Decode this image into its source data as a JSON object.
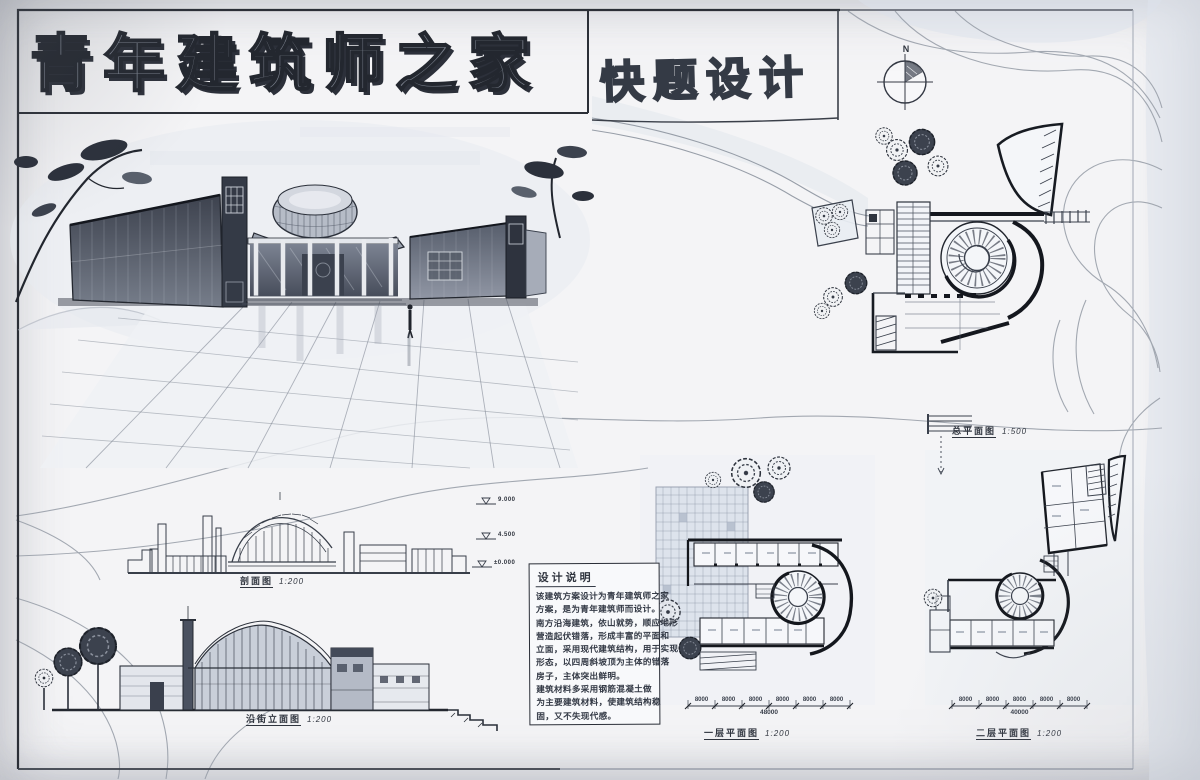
{
  "board": {
    "title_main": "青年建筑师之家",
    "title_sub": "快题设计",
    "north_label": "N"
  },
  "labels": {
    "site_plan": {
      "name": "总平面图",
      "scale": "1:500"
    },
    "section": {
      "name": "剖面图",
      "scale": "1:200"
    },
    "street_elevation": {
      "name": "沿街立面图",
      "scale": "1:200"
    },
    "floor_plan_1": {
      "name": "一层平面图",
      "scale": "1:200"
    },
    "floor_plan_2": {
      "name": "二层平面图",
      "scale": "1:200"
    }
  },
  "levels": [
    "9.000",
    "4.500",
    "±0.000"
  ],
  "notes": {
    "title": "设计说明",
    "lines": [
      "该建筑方案设计为青年建筑师之家",
      "方案，是为青年建筑师而设计。",
      "南方沿海建筑，依山就势，顺应地形",
      "营造起伏错落，形成丰富的平面和",
      "立面，采用现代建筑结构，用于实现",
      "形态，以四周斜坡顶为主体的错落",
      "房子，主体突出鲜明。",
      "建筑材料多采用钢筋混凝土做",
      "为主要建筑材料，使建筑结构稳",
      "固，又不失现代感。"
    ]
  },
  "dimensions": {
    "plan1": {
      "segments": [
        "8000",
        "8000",
        "8000",
        "8000",
        "8000",
        "8000"
      ],
      "total": "48000"
    },
    "plan2": {
      "segments": [
        "8000",
        "8000",
        "8000",
        "8000",
        "8000"
      ],
      "total": "40000"
    }
  },
  "colors": {
    "ink": "#2f333c",
    "paper": "#f4f4f6",
    "wash_blue": "#dfe4ec",
    "dark_marker": "#3a3f49"
  }
}
